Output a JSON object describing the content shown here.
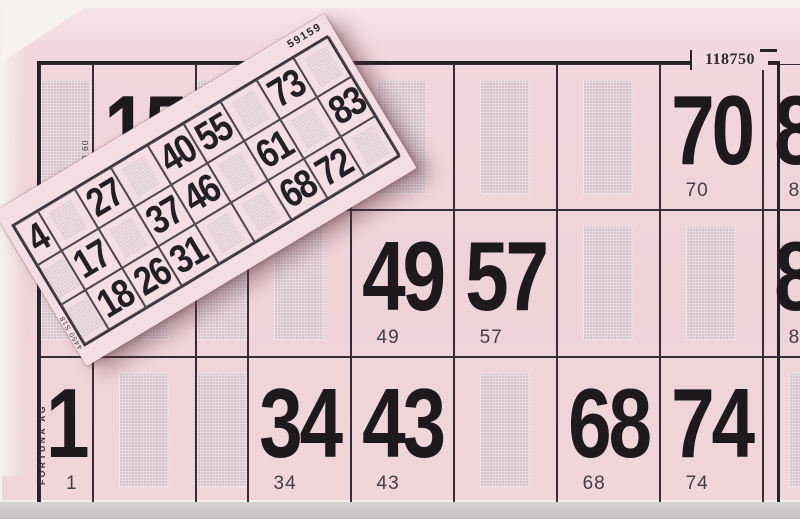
{
  "big_card": {
    "serial": "118750",
    "phone_vertical_text": "061 1 976 90 60",
    "brand_vertical_text": "FORTUNA AG",
    "grid": {
      "rows": 3,
      "cols": 9
    },
    "cells": [
      [
        "",
        "15",
        "",
        "",
        "",
        "",
        "",
        "70",
        "85"
      ],
      [
        "",
        "",
        "",
        "",
        "49",
        "57",
        "",
        "",
        "82"
      ],
      [
        "1",
        "",
        "",
        "34",
        "43",
        "",
        "68",
        "74",
        ""
      ]
    ],
    "small_number_note": "each numbered cell repeats its number in small print at bottom-left"
  },
  "ticket": {
    "serial": "59159",
    "edge_text": "4450 S18",
    "grid": {
      "rows": 3,
      "cols": 9
    },
    "cells": [
      [
        "4",
        "",
        "27",
        "",
        "40",
        "55",
        "",
        "73",
        ""
      ],
      [
        "",
        "17",
        "",
        "37",
        "46",
        "",
        "61",
        "",
        "83"
      ],
      [
        "",
        "18",
        "26",
        "31",
        "",
        "",
        "68",
        "72",
        ""
      ]
    ]
  },
  "colors": {
    "card_pink": "#efd4da",
    "ticket_pink": "#f4dde3",
    "blank_shade": "#dbc5cd",
    "grid_line": "#2a2329",
    "number_black": "#1d191d",
    "small_number_gray": "#453d43",
    "background": "#f5f0ee",
    "bottom_strip": "#c7c0c2"
  }
}
